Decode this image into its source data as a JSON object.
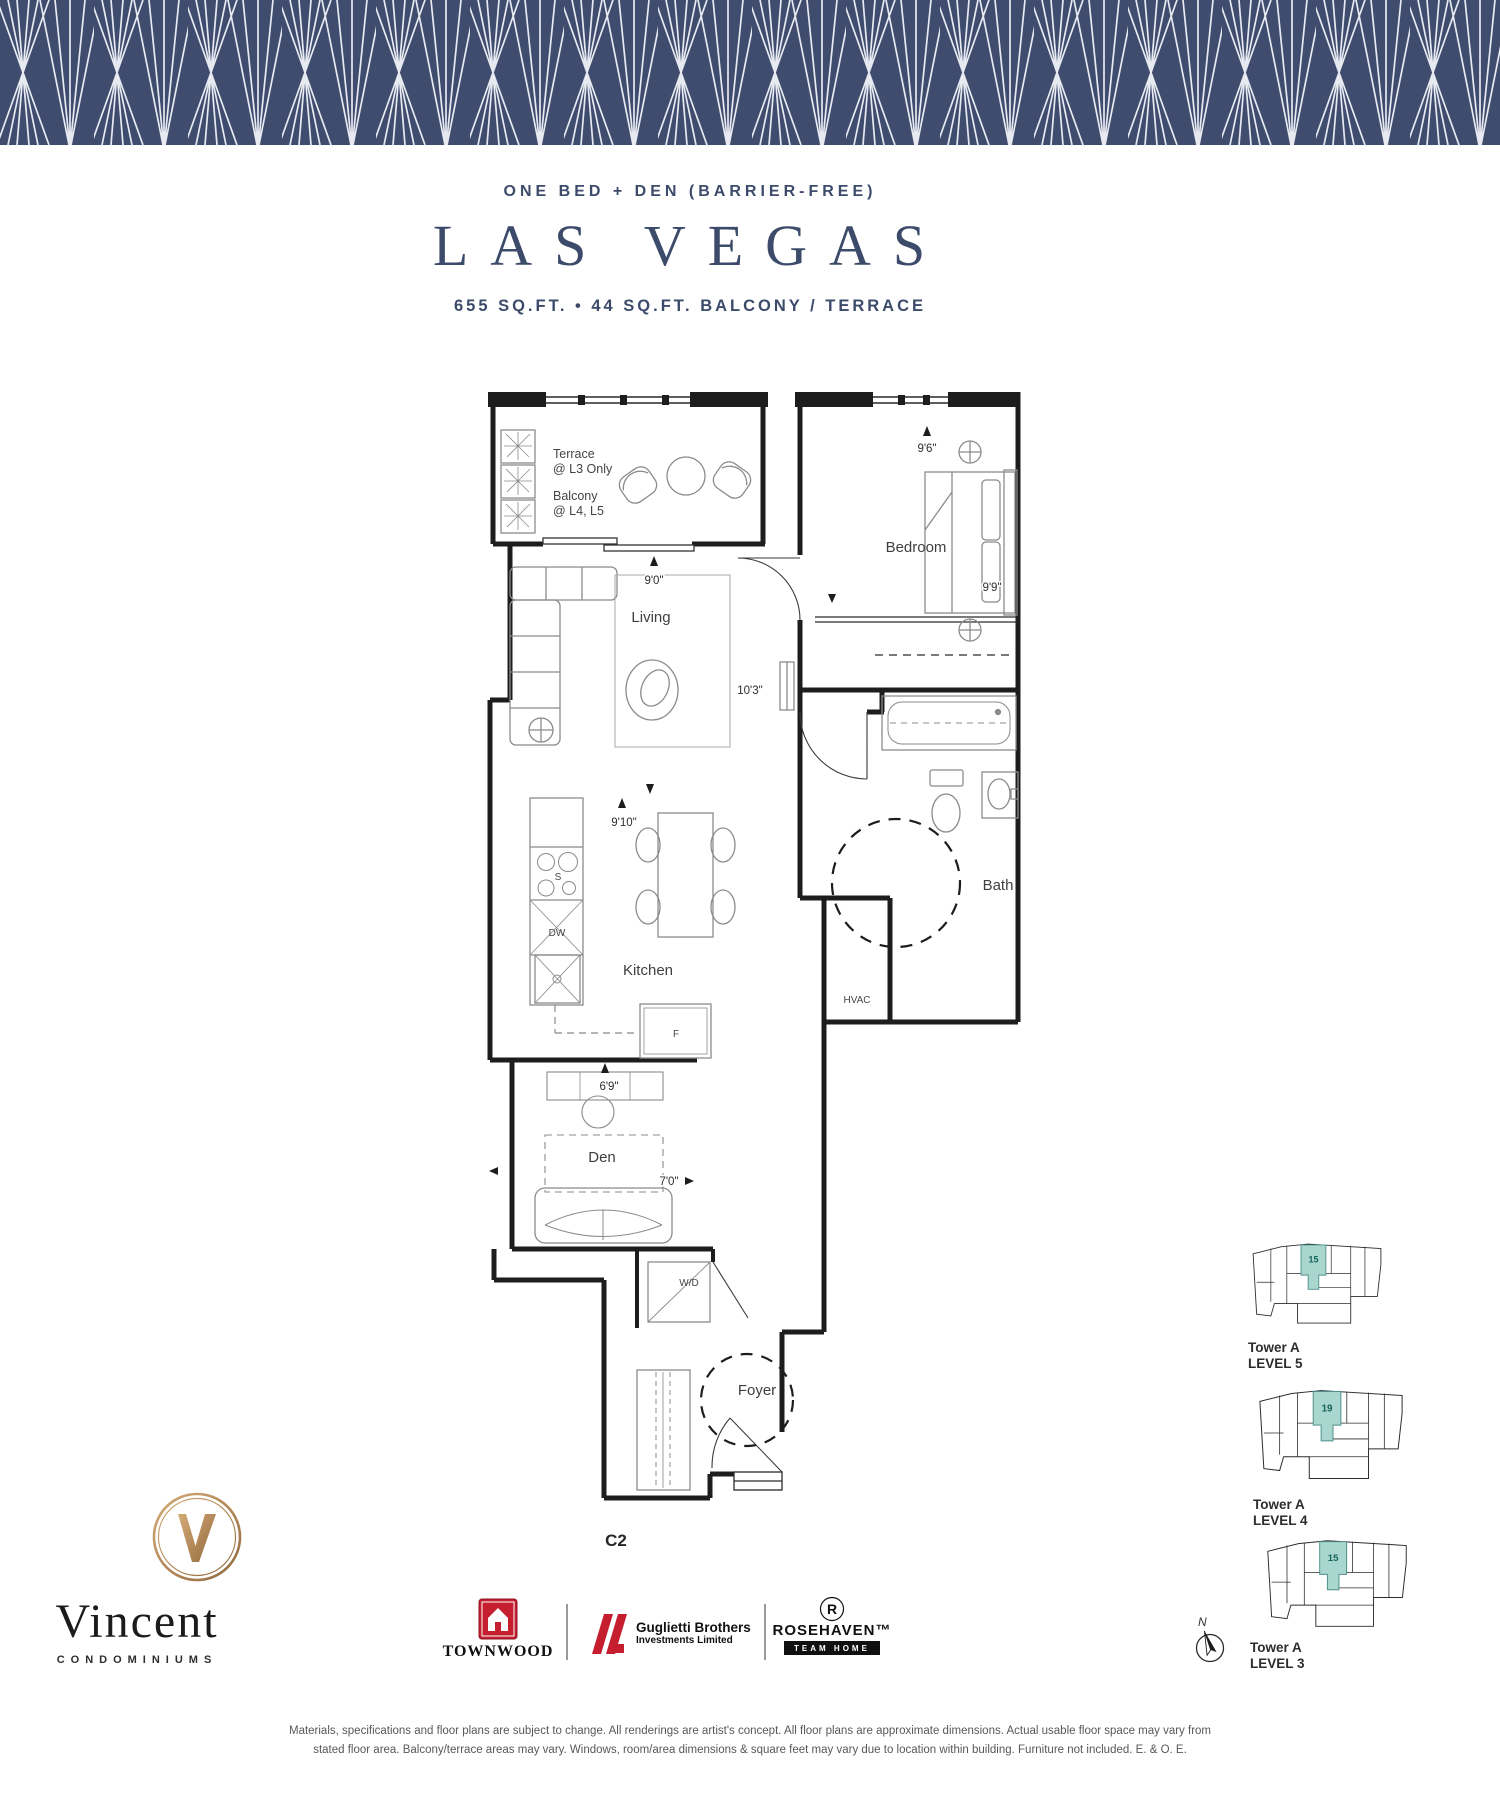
{
  "header": {
    "kicker": "ONE BED + DEN (BARRIER-FREE)",
    "title": "LAS VEGAS",
    "subtitle": "655 SQ.FT. • 44 SQ.FT. BALCONY / TERRACE"
  },
  "plan": {
    "unit_code": "C2",
    "labels": {
      "terrace1": "Terrace",
      "terrace2": "@ L3 Only",
      "balcony1": "Balcony",
      "balcony2": "@ L4, L5",
      "bedroom": "Bedroom",
      "living": "Living",
      "kitchen": "Kitchen",
      "bath": "Bath",
      "den": "Den",
      "foyer": "Foyer",
      "hvac": "HVAC",
      "washer_dryer": "W/D",
      "fridge": "F",
      "stove": "S",
      "dishwasher": "DW"
    },
    "dimensions": {
      "bedroom_width": "9'6\"",
      "bedroom_depth": "9'9\"",
      "living_width": "9'0\"",
      "living_depth": "10'3\"",
      "kitchen_width": "9'10\"",
      "den_width": "6'9\"",
      "den_depth": "7'0\""
    }
  },
  "keyplans": {
    "items": [
      {
        "tower": "Tower A",
        "level": "LEVEL 5",
        "unit": "15"
      },
      {
        "tower": "Tower A",
        "level": "LEVEL 4",
        "unit": "19"
      },
      {
        "tower": "Tower A",
        "level": "LEVEL 3",
        "unit": "15"
      }
    ],
    "highlight_color": "#a9d6cf"
  },
  "compass": {
    "north": "N"
  },
  "branding": {
    "name": "Vincent",
    "subtitle": "CONDOMINIUMS",
    "partners": {
      "townwood": {
        "name": "TOWNWOOD"
      },
      "guglietti": {
        "line1": "Guglietti Brothers",
        "line2": "Investments Limited"
      },
      "rosehaven": {
        "name": "ROSEHAVEN™",
        "tagline": "TEAM HOME"
      }
    }
  },
  "disclaimer": {
    "line1": "Materials, specifications and floor plans are subject to change. All renderings are artist's concept. All floor plans are approximate dimensions. Actual usable floor space may vary from",
    "line2": "stated floor area. Balcony/terrace areas may vary. Windows, room/area dimensions & square feet may vary due to location within building. Furniture not included. E. & O. E."
  },
  "colors": {
    "banner_navy": "#3f4c6e",
    "title_navy": "#3d4b6b",
    "plan_ink": "#1d1d1d",
    "teal_highlight": "#a9d6cf",
    "gold": "#b5895a",
    "brand_red": "#c41e2f"
  }
}
